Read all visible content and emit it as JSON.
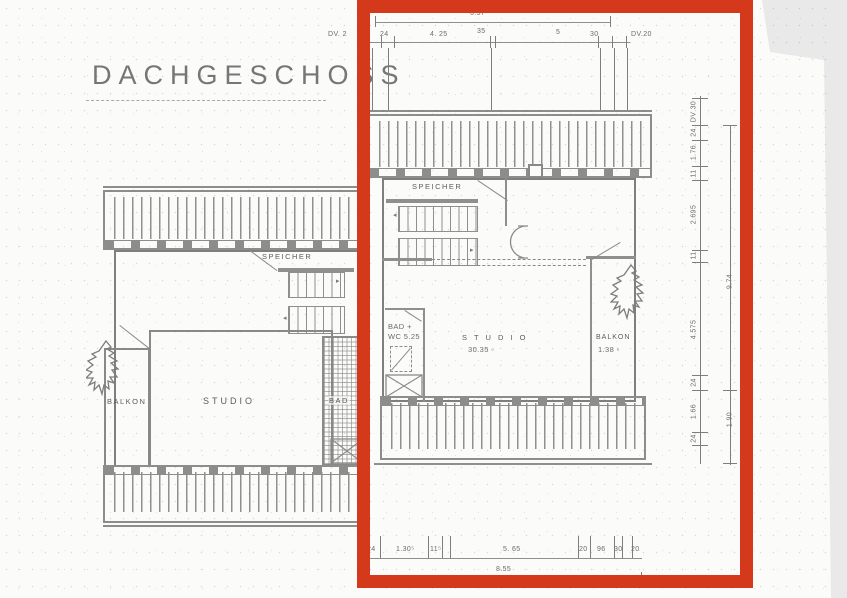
{
  "page": {
    "title": "DACHGESCHOSS"
  },
  "left_unit": {
    "speicher": "SPEICHER",
    "balkon": "BALKON",
    "studio": "STUDIO",
    "bad": "BAD"
  },
  "right_unit": {
    "speicher": "SPEICHER",
    "bad_line1": "BAD +",
    "bad_line2": "WC 5.25",
    "studio_line1": "S T U D I O",
    "studio_line2": "30.35 ▫",
    "balkon_line1": "BALKON",
    "balkon_line2": "1.38 ▫"
  },
  "dims": {
    "top": {
      "overall": "6.57",
      "dv_left": "DV. 2",
      "segments": [
        "24",
        "4. 25",
        "35",
        "5",
        "30"
      ],
      "dv_right": "DV.20"
    },
    "bottom": {
      "overall": "8.55",
      "segments": [
        "24",
        "1.30⁵",
        "11⁵",
        "5. 65",
        "20",
        "96",
        "30",
        "20"
      ]
    },
    "right": {
      "overall": "9.74",
      "lower": "1.90",
      "segments": [
        "DV 30",
        "24",
        "1.76",
        "11",
        "2.695",
        "11",
        "4.575",
        "24",
        "1.66",
        "24"
      ]
    }
  },
  "colors": {
    "highlight": "#d5391b",
    "ink": "#8a8a8a"
  }
}
